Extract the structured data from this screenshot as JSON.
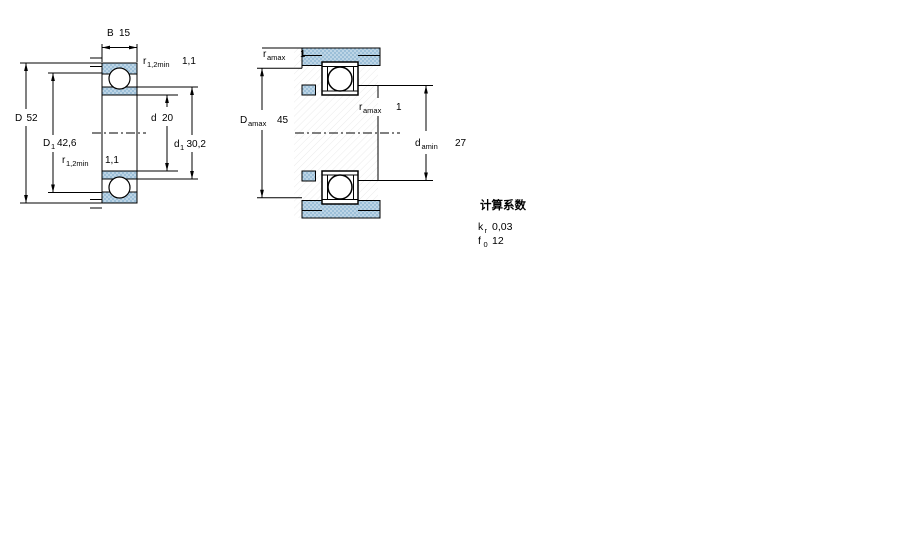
{
  "figure": {
    "type": "bearing-technical-drawing",
    "colors": {
      "stipple_fill": "#9cbfd8",
      "stipple_dot": "#d5e5f1",
      "hatch_line": "#ebebeb",
      "line": "#000000"
    },
    "left_view": {
      "dims": {
        "B": {
          "label": "B",
          "value": "15"
        },
        "r_top": {
          "label": "r",
          "sub": "1,2min",
          "value": "1,1"
        },
        "D": {
          "label": "D",
          "value": "52"
        },
        "D1": {
          "label": "D",
          "sub": "1",
          "value": "42,6"
        },
        "r_bottom": {
          "label": "r",
          "sub": "1,2min",
          "value": "1,1"
        },
        "d": {
          "label": "d",
          "value": "20"
        },
        "d1": {
          "label": "d",
          "sub": "1",
          "value": "30,2"
        }
      }
    },
    "right_view": {
      "dims": {
        "ra_top": {
          "label": "r",
          "sub": "amax",
          "value": "1"
        },
        "Da": {
          "label": "D",
          "sub": "amax",
          "value": "45"
        },
        "ra_mid": {
          "label": "r",
          "sub": "amax",
          "value": "1"
        },
        "da": {
          "label": "d",
          "sub": "amin",
          "value": "27"
        }
      }
    },
    "calc_factors": {
      "title": "计算系数",
      "rows": [
        {
          "label": "k",
          "sub": "r",
          "value": "0,03"
        },
        {
          "label": "f",
          "sub": "0",
          "value": "12"
        }
      ]
    }
  }
}
